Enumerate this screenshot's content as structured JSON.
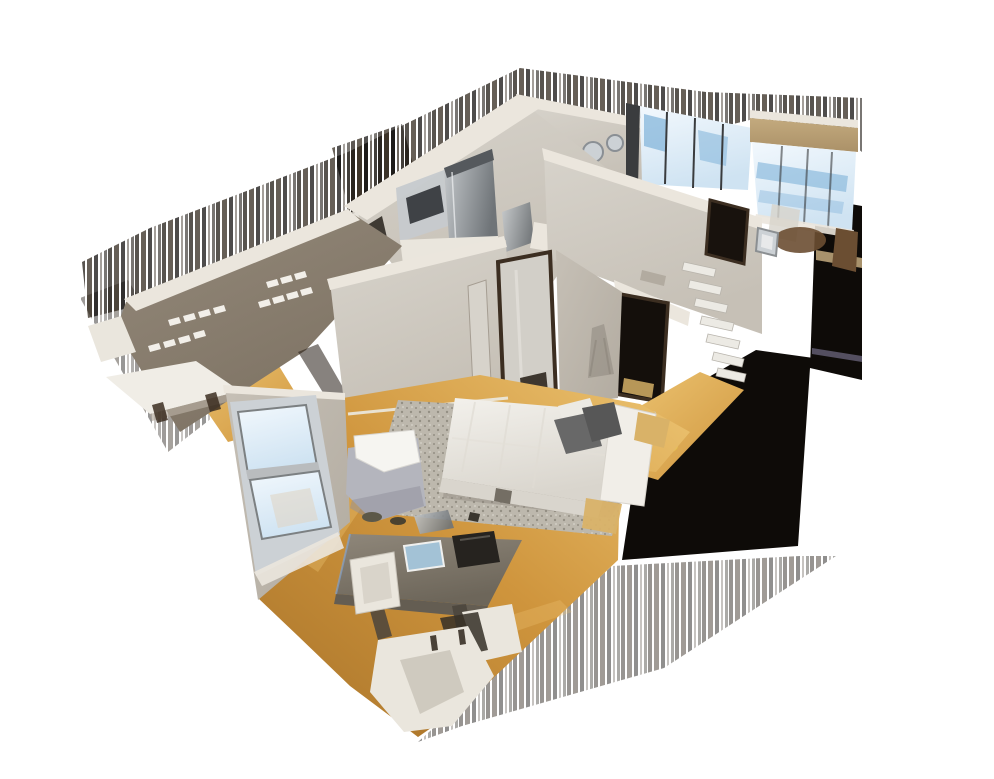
{
  "scene": {
    "description": "3D dollhouse cutaway view of an apartment scan (bedroom with bed and rug, desk and chairs, kitchen with stainless appliances, closet with shelving, hallway, living room with large windows) floating on a white background",
    "background": "#ffffff"
  },
  "colors": {
    "cut_top": "#ebe6dd",
    "wall_light": "#d7d3cb",
    "wall_mid": "#c6c0b6",
    "wall_shaded": "#b2aba0",
    "closet_wall": "#94897a",
    "closet_wall_dark": "#7d7263",
    "wood_light": "#edc573",
    "wood_main": "#cf953d",
    "wood_deep": "#a9742a",
    "window_glow": "#f2f8fd",
    "window_sky": "#cfe3f2",
    "window_blue": "#7fb2d9",
    "window_frame": "#3a3c3e",
    "steel_light": "#c6cacd",
    "steel_dark": "#6f7478",
    "soffit_tan": "#c3aa7e",
    "soffit_tan_dark": "#ab9168",
    "door_brown": "#3c2e21",
    "dark_cut": "#0e0b08",
    "bed_white": "#f3f1ec",
    "bed_shadow": "#d9d5cd",
    "pillow_gray": "#686868",
    "pillow_dark": "#575757",
    "rug_base": "#bdb8ad",
    "rug_dot": "#948f84",
    "table_wood": "#8f877a",
    "table_wood_dark": "#6d665a",
    "chair_white": "#eae6dd",
    "armchair_gray": "#b4b5bd",
    "blanket_white": "#f6f5f1",
    "book_blue": "#a3c2d6",
    "bag_black": "#26231f",
    "accent_orange": "#c2512b",
    "mirror_silver": "#ccd1d5",
    "basket_brown": "#7a5a38",
    "furniture_brown": "#6b4e32",
    "tan_wood": "#d9b268",
    "lavender_stripe": "#9a93b8",
    "accent_yellow": "#e9c653",
    "led_blue": "#7fa8e0",
    "streak_dark": "#17110b",
    "streak_mid": "#2b2115",
    "streak_deep": "#090705"
  }
}
